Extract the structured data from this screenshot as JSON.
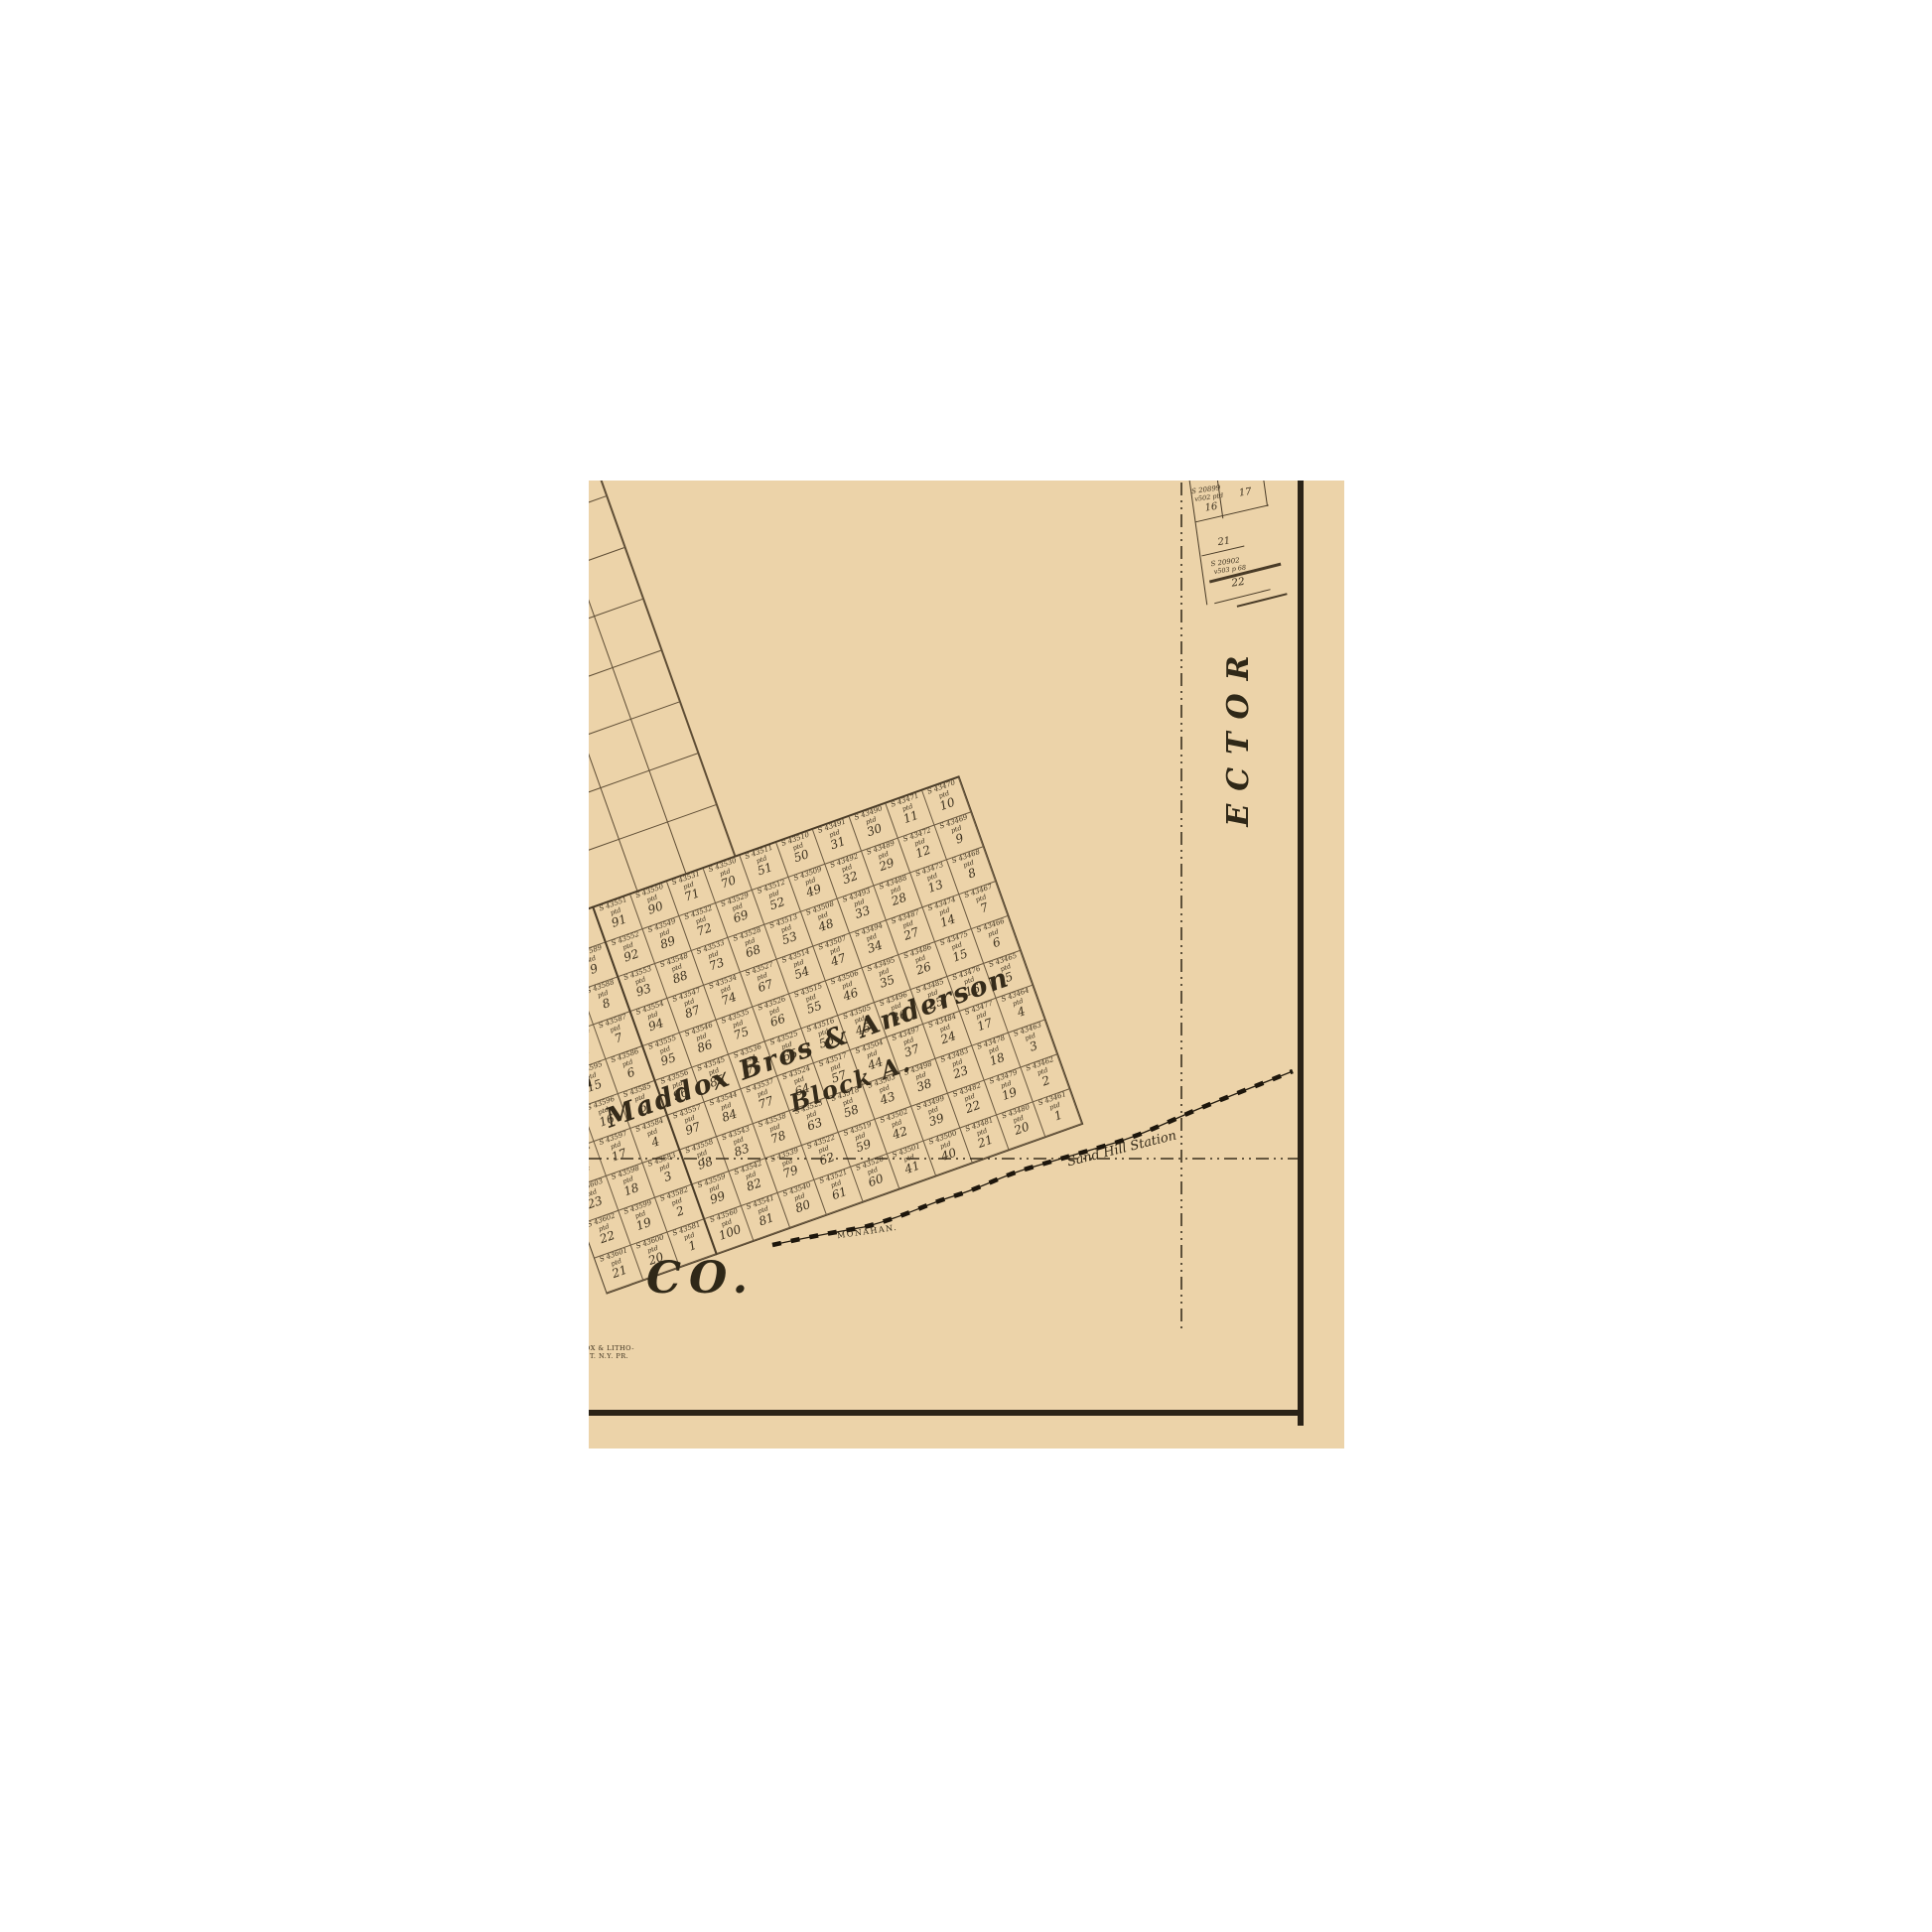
{
  "map": {
    "region_labels": {
      "neighbor_county": "ECTOR",
      "county_suffix": "CO."
    },
    "block_a": {
      "owner": "Maddox Bros & Anderson",
      "name": "Block A.",
      "survey_prefix": "S ",
      "survey_status": "ptd",
      "survey_base": 43460,
      "columns": [
        [
          91,
          92,
          93,
          94,
          95,
          96,
          97,
          98,
          99,
          100
        ],
        [
          90,
          89,
          88,
          87,
          86,
          85,
          84,
          83,
          82,
          81
        ],
        [
          71,
          72,
          73,
          74,
          75,
          76,
          77,
          78,
          79,
          80
        ],
        [
          70,
          69,
          68,
          67,
          66,
          65,
          64,
          63,
          62,
          61
        ],
        [
          51,
          52,
          53,
          54,
          55,
          56,
          57,
          58,
          59,
          60
        ],
        [
          50,
          49,
          48,
          47,
          46,
          45,
          44,
          43,
          42,
          41
        ],
        [
          31,
          32,
          33,
          34,
          35,
          36,
          37,
          38,
          39,
          40
        ],
        [
          30,
          29,
          28,
          27,
          26,
          25,
          24,
          23,
          22,
          21
        ],
        [
          11,
          12,
          13,
          14,
          15,
          16,
          17,
          18,
          19,
          20
        ],
        [
          10,
          9,
          8,
          7,
          6,
          5,
          4,
          3,
          2,
          1
        ]
      ]
    },
    "west_block": {
      "partial_label": "on",
      "survey_prefix": "S ",
      "survey_status": "ptd",
      "survey_base": 43580,
      "columns": [
        [
          30,
          29,
          28,
          27,
          26,
          25,
          24,
          23,
          22,
          21
        ],
        [
          11,
          12,
          13,
          14,
          15,
          16,
          17,
          18,
          19,
          20
        ],
        [
          10,
          9,
          8,
          7,
          6,
          5,
          4,
          3,
          2,
          1
        ]
      ]
    },
    "ne_plots": {
      "cells": [
        {
          "survey": "S 20899",
          "note": "v502 ptd",
          "num": "16"
        },
        {
          "num": "17"
        },
        {
          "num": "21"
        },
        {
          "survey": "S 20902",
          "note": "v503 p 68",
          "num": "22"
        }
      ]
    },
    "railroad": {
      "station_label": "Sand Hill Station",
      "town_label": "MONAHAN."
    },
    "imprint": {
      "line1": "OX & LITHO-",
      "line2": "ST. N.Y. PR."
    },
    "colors": {
      "paper": "#ffffff",
      "map_bg": "#ecd3a9",
      "grid_line": "#5f4e36",
      "ink": "#3c311f",
      "border_ink": "#2b2317",
      "rail_ink": "#1d160c"
    }
  }
}
